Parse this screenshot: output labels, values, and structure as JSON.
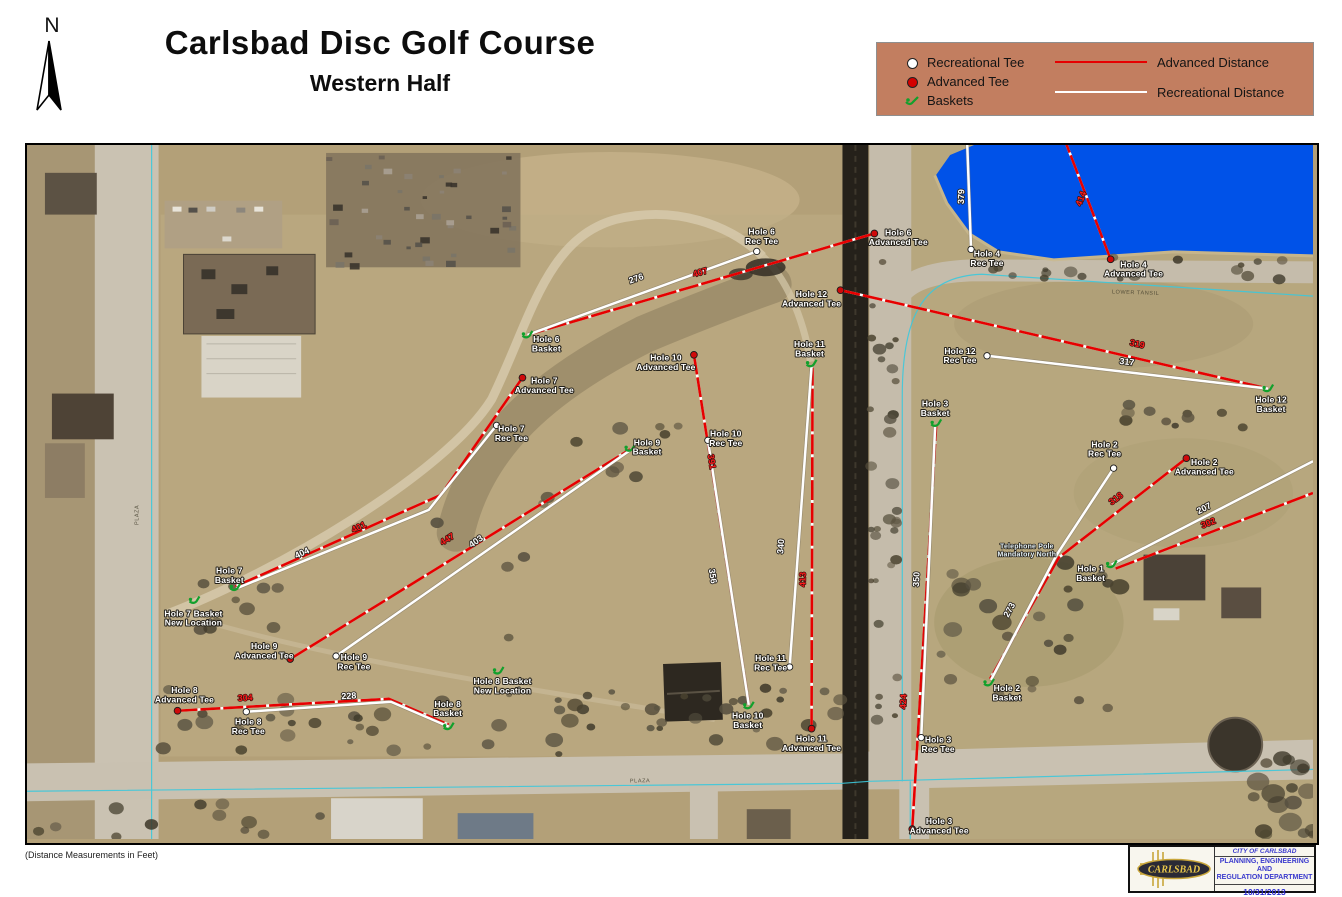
{
  "title": {
    "main": "Carlsbad Disc Golf Course",
    "sub": "Western Half"
  },
  "north": {
    "label": "N"
  },
  "footnote": {
    "text": "(Distance Measurements in Feet)"
  },
  "legend": {
    "background": "#c27e60",
    "items": [
      {
        "id": "recreational-tee",
        "label": "Recreational Tee",
        "color": "#ffffff"
      },
      {
        "id": "advanced-tee",
        "label": "Advanced Tee",
        "color": "#d40000"
      },
      {
        "id": "baskets",
        "label": "Baskets",
        "color": "#12a02c"
      },
      {
        "id": "advanced-distance",
        "label": "Advanced Distance",
        "color": "#e60000"
      },
      {
        "id": "recreational-distance",
        "label": "Recreational Distance",
        "color": "#ffffff"
      }
    ]
  },
  "colors": {
    "advanced_line": "#e60000",
    "recreational_line": "#ffffff",
    "basket_green": "#12a02c",
    "water": "#0052e8",
    "legend_bg": "#c27e60"
  },
  "stamp": {
    "city": "CITY OF CARLSBAD",
    "dept1": "PLANNING, ENGINEERING AND",
    "dept2": "REGULATION DEPARTMENT",
    "date": "10/31/2013",
    "logo_text": "CARLSBAD"
  },
  "map": {
    "markers": [
      {
        "id": "hole-6-rec-tee",
        "kind": "rec_tee",
        "x": 732,
        "y": 107,
        "lx": 737,
        "ly": 90,
        "label": "Hole 6|Rec Tee"
      },
      {
        "id": "hole-6-advanced-tee",
        "kind": "adv_tee",
        "x": 850,
        "y": 89,
        "lx": 874,
        "ly": 91,
        "label": "Hole 6|Advanced Tee"
      },
      {
        "id": "hole-6-basket",
        "kind": "basket",
        "x": 502,
        "y": 191,
        "lx": 521,
        "ly": 198,
        "label": "Hole 6|Basket"
      },
      {
        "id": "hole-4-rec-tee",
        "kind": "rec_tee",
        "x": 947,
        "y": 105,
        "lx": 963,
        "ly": 112,
        "label": "Hole 4|Rec Tee"
      },
      {
        "id": "hole-4-advanced-tee",
        "kind": "adv_tee",
        "x": 1087,
        "y": 115,
        "lx": 1110,
        "ly": 123,
        "label": "Hole 4|Advanced Tee"
      },
      {
        "id": "hole-12-advanced-tee",
        "kind": "adv_tee",
        "x": 816,
        "y": 146,
        "lx": 787,
        "ly": 153,
        "label": "Hole 12|Advanced Tee"
      },
      {
        "id": "hole-12-rec-tee",
        "kind": "rec_tee",
        "x": 963,
        "y": 212,
        "lx": 936,
        "ly": 210,
        "label": "Hole 12|Rec Tee"
      },
      {
        "id": "hole-12-basket",
        "kind": "basket",
        "x": 1245,
        "y": 245,
        "lx": 1248,
        "ly": 259,
        "label": "Hole 12|Basket"
      },
      {
        "id": "hole-11-basket",
        "kind": "basket",
        "x": 787,
        "y": 220,
        "lx": 785,
        "ly": 203,
        "label": "Hole 11|Basket"
      },
      {
        "id": "hole-11-rec-tee",
        "kind": "rec_tee",
        "x": 765,
        "y": 525,
        "lx": 746,
        "ly": 519,
        "label": "Hole 11|Rec Tee"
      },
      {
        "id": "hole-11-advanced-tee",
        "kind": "adv_tee",
        "x": 787,
        "y": 587,
        "lx": 787,
        "ly": 600,
        "label": "Hole 11|Advanced Tee"
      },
      {
        "id": "hole-10-advanced-tee",
        "kind": "adv_tee",
        "x": 669,
        "y": 211,
        "lx": 641,
        "ly": 217,
        "label": "Hole 10|Advanced Tee"
      },
      {
        "id": "hole-10-rec-tee",
        "kind": "rec_tee",
        "x": 683,
        "y": 297,
        "lx": 701,
        "ly": 293,
        "label": "Hole 10|Rec Tee"
      },
      {
        "id": "hole-10-basket",
        "kind": "basket",
        "x": 724,
        "y": 564,
        "lx": 723,
        "ly": 577,
        "label": "Hole 10|Basket"
      },
      {
        "id": "hole-9-advanced-tee",
        "kind": "adv_tee",
        "x": 264,
        "y": 517,
        "lx": 238,
        "ly": 507,
        "label": "Hole 9|Advanced Tee"
      },
      {
        "id": "hole-9-rec-tee",
        "kind": "rec_tee",
        "x": 310,
        "y": 514,
        "lx": 328,
        "ly": 518,
        "label": "Hole 9|Rec Tee"
      },
      {
        "id": "hole-9-basket",
        "kind": "basket",
        "x": 605,
        "y": 305,
        "lx": 622,
        "ly": 302,
        "label": "Hole 9|Basket"
      },
      {
        "id": "hole-7-advanced-tee",
        "kind": "adv_tee",
        "x": 497,
        "y": 234,
        "lx": 519,
        "ly": 240,
        "label": "Hole 7|Advanced Tee"
      },
      {
        "id": "hole-7-rec-tee",
        "kind": "rec_tee",
        "x": 471,
        "y": 282,
        "lx": 486,
        "ly": 288,
        "label": "Hole 7|Rec Tee"
      },
      {
        "id": "hole-7-basket",
        "kind": "basket",
        "x": 209,
        "y": 445,
        "lx": 203,
        "ly": 431,
        "label": "Hole 7|Basket"
      },
      {
        "id": "hole-7-basket-new-location",
        "kind": "basket",
        "x": 168,
        "y": 458,
        "lx": 167,
        "ly": 474,
        "label": "Hole 7 Basket|New Location"
      },
      {
        "id": "hole-8-advanced-tee",
        "kind": "adv_tee",
        "x": 151,
        "y": 569,
        "lx": 158,
        "ly": 551,
        "label": "Hole 8|Advanced Tee"
      },
      {
        "id": "hole-8-rec-tee",
        "kind": "rec_tee",
        "x": 220,
        "y": 570,
        "lx": 222,
        "ly": 583,
        "label": "Hole 8|Rec Tee"
      },
      {
        "id": "hole-8-basket",
        "kind": "basket",
        "x": 423,
        "y": 585,
        "lx": 422,
        "ly": 565,
        "label": "Hole 8|Basket"
      },
      {
        "id": "hole-8-basket-new-location",
        "kind": "basket",
        "x": 473,
        "y": 529,
        "lx": 477,
        "ly": 542,
        "label": "Hole 8 Basket|New Location"
      },
      {
        "id": "hole-3-basket",
        "kind": "basket",
        "x": 912,
        "y": 280,
        "lx": 911,
        "ly": 263,
        "label": "Hole 3|Basket"
      },
      {
        "id": "hole-3-rec-tee",
        "kind": "rec_tee",
        "x": 897,
        "y": 596,
        "lx": 914,
        "ly": 601,
        "label": "Hole 3|Rec Tee"
      },
      {
        "id": "hole-3-advanced-tee",
        "kind": "adv_tee",
        "x": 888,
        "y": 688,
        "lx": 915,
        "ly": 683,
        "label": "Hole 3|Advanced Tee"
      },
      {
        "id": "hole-2-rec-tee",
        "kind": "rec_tee",
        "x": 1090,
        "y": 325,
        "lx": 1081,
        "ly": 304,
        "label": "Hole 2|Rec Tee"
      },
      {
        "id": "hole-2-advanced-tee",
        "kind": "adv_tee",
        "x": 1163,
        "y": 315,
        "lx": 1181,
        "ly": 322,
        "label": "Hole 2|Advanced Tee"
      },
      {
        "id": "hole-2-basket",
        "kind": "basket",
        "x": 965,
        "y": 541,
        "lx": 983,
        "ly": 549,
        "label": "Hole 2|Basket"
      },
      {
        "id": "hole-1-basket",
        "kind": "basket",
        "x": 1088,
        "y": 422,
        "lx": 1067,
        "ly": 429,
        "label": "Hole 1|Basket"
      },
      {
        "id": "telephone-pole-note",
        "kind": "note",
        "lx": 1003,
        "ly": 406,
        "label": "Telephone Pole|Mandatory North"
      }
    ],
    "paths": [
      {
        "hole": "6",
        "kind": "rec",
        "dist": "276",
        "pts": "732,107 502,191",
        "dx": 612,
        "dy": 137,
        "rot": -20
      },
      {
        "hole": "6",
        "kind": "adv",
        "dist": "407",
        "pts": "850,89 502,191",
        "dx": 676,
        "dy": 131,
        "rot": -16
      },
      {
        "hole": "4",
        "kind": "rec",
        "dist": "379",
        "pts": "947,105 943,-5",
        "dx": 940,
        "dy": 52,
        "rot": -88
      },
      {
        "hole": "4",
        "kind": "adv",
        "dist": "414",
        "pts": "1087,115 1041,-5",
        "dx": 1060,
        "dy": 55,
        "rot": -69
      },
      {
        "hole": "12",
        "kind": "adv",
        "dist": "319",
        "pts": "816,146 1245,245",
        "dx": 1113,
        "dy": 203,
        "rot": 13
      },
      {
        "hole": "12",
        "kind": "rec",
        "dist": "317",
        "pts": "963,212 1245,245",
        "dx": 1103,
        "dy": 221,
        "rot": 7
      },
      {
        "hole": "11",
        "kind": "rec",
        "dist": "340",
        "pts": "765,525 787,222",
        "dx": 759,
        "dy": 404,
        "rot": -86
      },
      {
        "hole": "11",
        "kind": "adv",
        "dist": "413",
        "pts": "787,587 788,224",
        "dx": 781,
        "dy": 437,
        "rot": -89
      },
      {
        "hole": "10",
        "kind": "adv",
        "dist": "391",
        "pts": "669,211 724,562",
        "dx": 684,
        "dy": 319,
        "rot": 81
      },
      {
        "hole": "10",
        "kind": "rec",
        "dist": "356",
        "pts": "683,297 724,563",
        "dx": 685,
        "dy": 434,
        "rot": 81
      },
      {
        "hole": "9",
        "kind": "adv",
        "dist": "447",
        "pts": "264,517 605,306",
        "dx": 423,
        "dy": 399,
        "rot": -32
      },
      {
        "hole": "9",
        "kind": "rec",
        "dist": "403",
        "pts": "310,514 605,307",
        "dx": 452,
        "dy": 401,
        "rot": -35
      },
      {
        "hole": "7",
        "kind": "adv",
        "dist": "401",
        "pts": "497,234 415,352 209,444",
        "dx": 334,
        "dy": 387,
        "rot": -25
      },
      {
        "hole": "7",
        "kind": "rec",
        "dist": "404",
        "pts": "471,282 403,367 210,446",
        "dx": 277,
        "dy": 413,
        "rot": -25
      },
      {
        "hole": "8",
        "kind": "adv",
        "dist": "304",
        "pts": "151,569 363,557 423,583",
        "dx": 219,
        "dy": 559,
        "rot": -3
      },
      {
        "hole": "8",
        "kind": "rec",
        "dist": "228",
        "pts": "220,570 365,560 423,585",
        "dx": 323,
        "dy": 557,
        "rot": -3
      },
      {
        "hole": "3",
        "kind": "adv",
        "dist": "424",
        "pts": "888,688 912,283",
        "dx": 882,
        "dy": 560,
        "rot": -87
      },
      {
        "hole": "3",
        "kind": "rec",
        "dist": "350",
        "pts": "897,596 911,282",
        "dx": 895,
        "dy": 437,
        "rot": -87
      },
      {
        "hole": "2",
        "kind": "rec",
        "dist": "273",
        "pts": "1090,325 1033,412 967,538",
        "dx": 988,
        "dy": 469,
        "rot": -62
      },
      {
        "hole": "2",
        "kind": "adv",
        "dist": "318",
        "pts": "1163,315 1035,415 966,537",
        "dx": 1094,
        "dy": 358,
        "rot": -37
      },
      {
        "hole": "1",
        "kind": "rec",
        "dist": "207",
        "pts": "1088,422 1290,318",
        "dx": 1182,
        "dy": 368,
        "rot": -27
      },
      {
        "hole": "1",
        "kind": "adv",
        "dist": "302",
        "pts": "1092,426 1290,350",
        "dx": 1186,
        "dy": 383,
        "rot": -21
      }
    ],
    "road_labels": [
      {
        "text": "LOWER TANSIL",
        "x": 1112,
        "y": 150,
        "rot": 2
      },
      {
        "text": "PLAZA",
        "x": 112,
        "y": 372,
        "rot": -90
      },
      {
        "text": "PLAZA",
        "x": 615,
        "y": 641,
        "rot": -1
      }
    ]
  }
}
